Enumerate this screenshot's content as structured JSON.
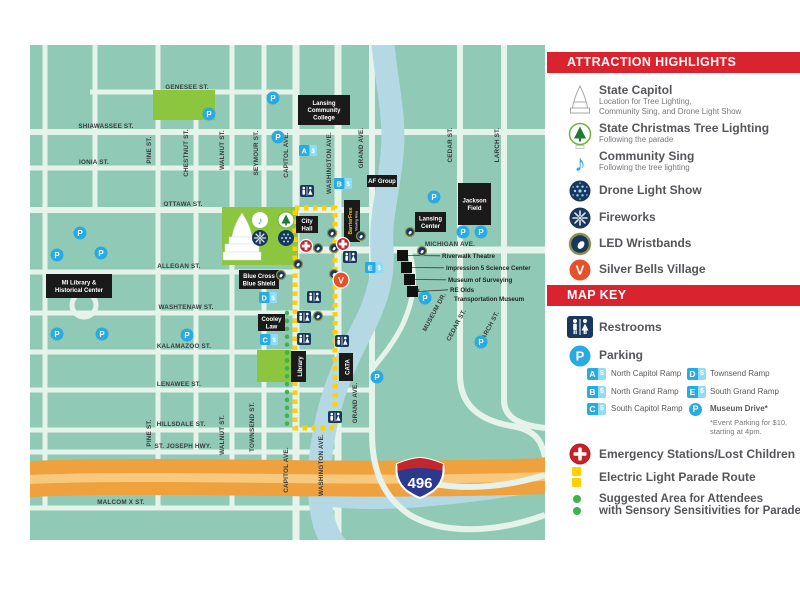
{
  "panel": {
    "attraction_header": "ATTRACTION HIGHLIGHTS",
    "map_key_header": "MAP KEY",
    "attractions": [
      {
        "icon": "capitol",
        "title": "State Capitol",
        "sub1": "Location for Tree Lighting,",
        "sub2": "Community Sing, and Drone Light Show"
      },
      {
        "icon": "tree",
        "title": "State Christmas Tree Lighting",
        "sub1": "Following the parade"
      },
      {
        "icon": "note",
        "title": "Community Sing",
        "sub1": "Following the tree lighting"
      },
      {
        "icon": "drone",
        "title": "Drone Light Show"
      },
      {
        "icon": "fireworks",
        "title": "Fireworks"
      },
      {
        "icon": "wristband",
        "title": "LED Wristbands"
      },
      {
        "icon": "village",
        "title": "Silver Bells Village"
      }
    ],
    "key": {
      "restrooms": "Restrooms",
      "parking": "Parking",
      "badge_suffix": "$",
      "ramps": [
        {
          "badge": "A",
          "label": "North Capitol Ramp"
        },
        {
          "badge": "B",
          "label": "North Grand Ramp"
        },
        {
          "badge": "C",
          "label": "South Capitol Ramp"
        },
        {
          "badge": "D",
          "label": "Townsend Ramp"
        },
        {
          "badge": "E",
          "label": "South Grand Ramp"
        }
      ],
      "museum_drive": "Museum Drive*",
      "museum_note_1": "*Event Parking for $10,",
      "museum_note_2": "starting at 4pm.",
      "parking_letter": "P",
      "emergency": "Emergency Stations/Lost Children",
      "parade": "Electric Light Parade Route",
      "sensory_1": "Suggested Area for Attendees",
      "sensory_2": "with Sensory Sensitivities for Parade Viewing"
    }
  },
  "map": {
    "i496_label": "496",
    "street_labels_h": [
      {
        "t": "GENESEE ST.",
        "x": 157,
        "y": 44
      },
      {
        "t": "SHIAWASSEE ST.",
        "x": 76,
        "y": 83
      },
      {
        "t": "IONIA ST.",
        "x": 64,
        "y": 119
      },
      {
        "t": "OTTAWA ST.",
        "x": 153,
        "y": 161
      },
      {
        "t": "MICHIGAN AVE.",
        "x": 420,
        "y": 201
      },
      {
        "t": "ALLEGAN ST.",
        "x": 149,
        "y": 223
      },
      {
        "t": "WASHTENAW ST.",
        "x": 156,
        "y": 264
      },
      {
        "t": "KALAMAZOO ST.",
        "x": 154,
        "y": 303
      },
      {
        "t": "LENAWEE ST.",
        "x": 149,
        "y": 341
      },
      {
        "t": "HILLSDALE ST.",
        "x": 151,
        "y": 381
      },
      {
        "t": "ST. JOSEPH HWY.",
        "x": 153,
        "y": 403
      },
      {
        "t": "MALCOM X ST.",
        "x": 91,
        "y": 459
      }
    ],
    "street_labels_v": [
      {
        "t": "PINE ST.",
        "x": 121,
        "y": 105
      },
      {
        "t": "CHESTNUT ST.",
        "x": 158,
        "y": 108
      },
      {
        "t": "WALNUT ST.",
        "x": 194,
        "y": 105
      },
      {
        "t": "SEYMOUR ST.",
        "x": 228,
        "y": 108
      },
      {
        "t": "CAPITOL AVE.",
        "x": 258,
        "y": 110
      },
      {
        "t": "WASHINGTON AVE.",
        "x": 301,
        "y": 118
      },
      {
        "t": "GRAND AVE.",
        "x": 333,
        "y": 103
      },
      {
        "t": "CEDAR ST.",
        "x": 422,
        "y": 100
      },
      {
        "t": "LARCH ST.",
        "x": 469,
        "y": 100
      },
      {
        "t": "PINE ST.",
        "x": 121,
        "y": 388
      },
      {
        "t": "WALNUT ST.",
        "x": 194,
        "y": 390
      },
      {
        "t": "TOWNSEND ST.",
        "x": 224,
        "y": 382
      },
      {
        "t": "CAPITOL AVE.",
        "x": 258,
        "y": 425
      },
      {
        "t": "WASHINGTON AVE.",
        "x": 293,
        "y": 420
      },
      {
        "t": "GRAND AVE.",
        "x": 327,
        "y": 358
      },
      {
        "t": "CEDAR ST.",
        "x": 428,
        "y": 281,
        "r": -62
      },
      {
        "t": "LARCH ST.",
        "x": 461,
        "y": 283,
        "r": -62
      },
      {
        "t": "MUSEUM DR.",
        "x": 406,
        "y": 268,
        "r": -62
      }
    ],
    "landmarks": [
      {
        "id": "lansing-community-college",
        "lines": [
          "Lansing",
          "Community",
          "College"
        ],
        "x": 268,
        "y": 50,
        "w": 52,
        "h": 30
      },
      {
        "id": "af-group",
        "lines": [
          "AF Group"
        ],
        "x": 337,
        "y": 130,
        "w": 30,
        "h": 12
      },
      {
        "id": "jackson-field",
        "lines": [
          "Jackson",
          "Field"
        ],
        "x": 428,
        "y": 138,
        "w": 33,
        "h": 42
      },
      {
        "id": "lansing-center",
        "lines": [
          "Lansing",
          "Center"
        ],
        "x": 385,
        "y": 167,
        "w": 31,
        "h": 20
      },
      {
        "id": "city-hall",
        "lines": [
          "City",
          "Hall"
        ],
        "x": 266,
        "y": 171,
        "w": 22,
        "h": 17
      },
      {
        "id": "blue-cross-blue-shield",
        "lines": [
          "Blue Cross",
          "Blue Shield"
        ],
        "x": 209,
        "y": 225,
        "w": 40,
        "h": 19
      },
      {
        "id": "cooley-law",
        "lines": [
          "Cooley",
          "Law"
        ],
        "x": 228,
        "y": 269,
        "w": 27,
        "h": 17
      },
      {
        "id": "mi-library-historical-center",
        "lines": [
          "MI Library &",
          "Historical Center"
        ],
        "x": 16,
        "y": 229,
        "w": 66,
        "h": 24
      },
      {
        "id": "library",
        "lines": [
          "Library"
        ],
        "x": 261,
        "y": 306,
        "w": 15,
        "h": 31,
        "vert": true
      },
      {
        "id": "cata",
        "lines": [
          "CATA"
        ],
        "x": 309,
        "y": 308,
        "w": 14,
        "h": 28,
        "vert": true
      },
      {
        "id": "barrier-free-viewing",
        "lines": [
          "BarrierFree"
        ],
        "sub": "Viewing Area",
        "x": 314,
        "y": 155,
        "w": 16,
        "h": 42,
        "vert": true,
        "accent": true
      }
    ],
    "museums": {
      "squares": [
        [
          367,
          205
        ],
        [
          371,
          217
        ],
        [
          374,
          229
        ],
        [
          377,
          241
        ]
      ],
      "labels": [
        {
          "t": "Riverwalk Theatre",
          "x": 412,
          "y": 213,
          "sq": 0
        },
        {
          "t": "Impression 5 Science Center",
          "x": 416,
          "y": 225,
          "sq": 1
        },
        {
          "t": "Museum of Surveying",
          "x": 418,
          "y": 237,
          "sq": 2
        },
        {
          "t": "RE Olds",
          "x": 420,
          "y": 247,
          "sq": 3
        },
        {
          "t": "Transportation Museum",
          "x": 424,
          "y": 256
        }
      ]
    },
    "parking": [
      [
        179,
        69
      ],
      [
        243,
        53
      ],
      [
        248,
        92
      ],
      [
        50,
        188
      ],
      [
        27,
        210
      ],
      [
        71,
        208
      ],
      [
        27,
        289
      ],
      [
        72,
        289
      ],
      [
        157,
        290
      ],
      [
        404,
        152
      ],
      [
        433,
        187
      ],
      [
        451,
        187
      ],
      [
        347,
        332
      ],
      [
        451,
        297
      ]
    ],
    "museum_drive_parking": {
      "x": 395,
      "y": 253,
      "mark": "*"
    },
    "restrooms": [
      [
        277,
        146
      ],
      [
        320,
        212
      ],
      [
        284,
        252
      ],
      [
        274,
        272
      ],
      [
        274,
        294
      ],
      [
        312,
        296
      ],
      [
        305,
        372
      ]
    ],
    "emergency": [
      [
        276,
        201
      ],
      [
        313,
        199
      ]
    ],
    "wristbands": [
      [
        302,
        188
      ],
      [
        288,
        203
      ],
      [
        304,
        203
      ],
      [
        331,
        191
      ],
      [
        268,
        219
      ],
      [
        304,
        229
      ],
      [
        251,
        230
      ],
      [
        288,
        271
      ],
      [
        380,
        187
      ],
      [
        392,
        206
      ]
    ],
    "village": {
      "x": 311,
      "y": 235,
      "letter": "V"
    },
    "ramp_badges": [
      {
        "l": "A",
        "x": 269,
        "y": 100
      },
      {
        "l": "B",
        "x": 304,
        "y": 133
      },
      {
        "l": "C",
        "x": 230,
        "y": 289
      },
      {
        "l": "D",
        "x": 229,
        "y": 247
      },
      {
        "l": "E",
        "x": 335,
        "y": 217
      }
    ]
  },
  "colors": {
    "block": "#90cab6",
    "street": "#e6f3eb",
    "river": "#b5d8e5",
    "park": "#8cc63e",
    "red": "#d9232e",
    "navy": "#17375e",
    "blue": "#29abe2",
    "lightblue": "#8edcf7",
    "yellow": "#ffd100",
    "green": "#3bb54a",
    "hwy": "#efa13d",
    "hwy_light": "#f7c97e",
    "emergency": "#cb2027",
    "village": "#e8502a",
    "box": "#1a1a1a"
  }
}
